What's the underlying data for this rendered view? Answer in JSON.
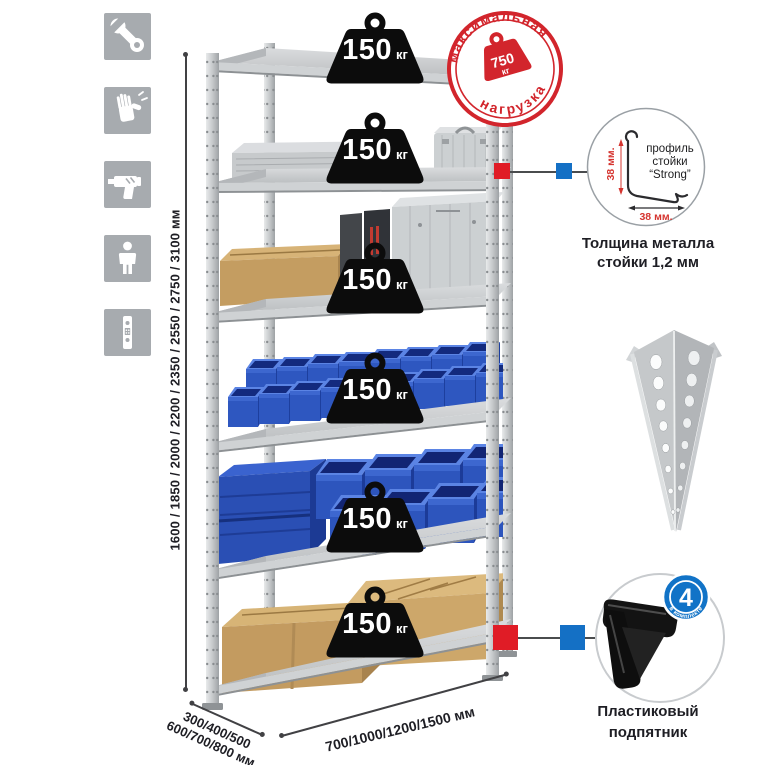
{
  "assembly_icons": {
    "tile_color": "#a7abaf",
    "items": [
      {
        "icon": "wrench-icon"
      },
      {
        "icon": "gloves-icon"
      },
      {
        "icon": "drill-icon"
      },
      {
        "icon": "person-icon"
      },
      {
        "icon": "perforated-profile-icon"
      }
    ]
  },
  "rack": {
    "shelf_count": 6,
    "shelf_load": {
      "value": "150",
      "unit": "кг"
    }
  },
  "max_load_stamp": {
    "arc_top": "максимальная",
    "arc_bottom": "нагрузка",
    "value": "750",
    "unit": "кг",
    "color": "#d2252c"
  },
  "profile_detail": {
    "label_line1": "профиль",
    "label_line2": "стойки",
    "label_line3": "“Strong”",
    "dim_vertical": "38 мм.",
    "dim_horizontal": "38 мм.",
    "caption_line1": "Толщина металла",
    "caption_line2": "стойки 1,2 мм"
  },
  "foot_detail": {
    "quantity": "4",
    "quantity_caption": "в комплекте",
    "badge_color": "#1173c7",
    "caption_line1": "Пластиковый",
    "caption_line2": "подпятник"
  },
  "dimensions": {
    "height": "1600 / 1850 / 2000 / 2200 / 2350 / 2550 / 2750 / 3100 мм",
    "depth_line1": "300/400/500",
    "depth_line2": "600/700/800 мм",
    "width": "700/1000/1200/1500 мм"
  },
  "markers": {
    "red": "#e01c26",
    "blue": "#1470c5"
  }
}
